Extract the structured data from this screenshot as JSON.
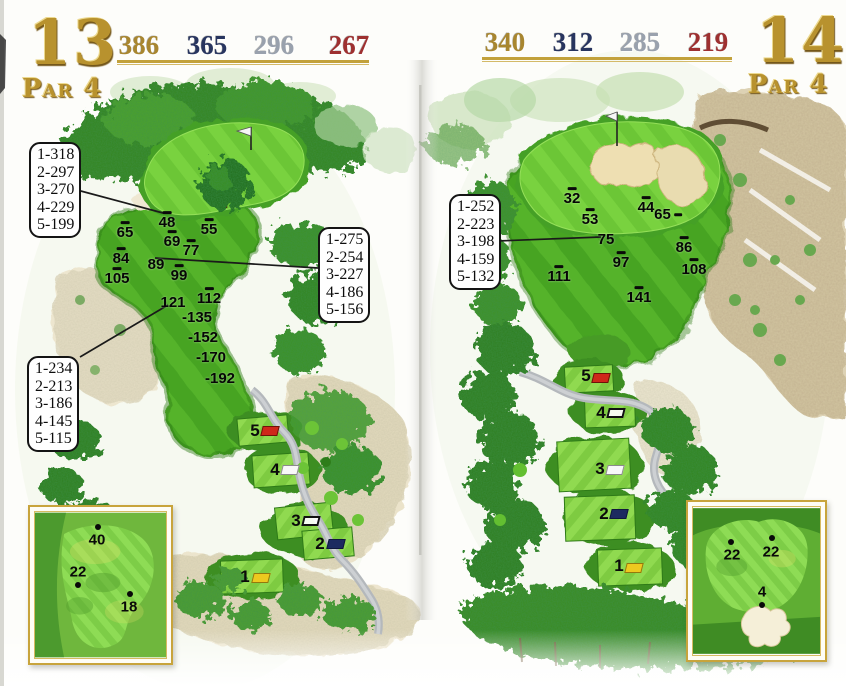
{
  "title": "Golf course yardage book spread — holes 13 and 14",
  "accent_gold": "#c2a13b",
  "tee_marker_colors": {
    "red": "#cf271a",
    "navy": "#1d2a60",
    "yellow": "#edc91f",
    "white": "#f8f8f8",
    "outline": "#ffffff"
  },
  "holes": [
    {
      "id": "13",
      "number": "13",
      "par": "Par 4",
      "distances": [
        {
          "value": "386",
          "color": "#a8862f",
          "x": 139,
          "y": 32
        },
        {
          "value": "365",
          "color": "#28355f",
          "x": 207,
          "y": 32
        },
        {
          "value": "296",
          "color": "#99a1ad",
          "x": 274,
          "y": 32
        },
        {
          "value": "267",
          "color": "#9e3030",
          "x": 349,
          "y": 32
        }
      ],
      "underline": {
        "x": 117,
        "y": 60,
        "w": 252
      },
      "callout_boxes": [
        {
          "x": 29,
          "y": 142,
          "lines": [
            "1-318",
            "2-297",
            "3-270",
            "4-229",
            "5-199"
          ]
        },
        {
          "x": 318,
          "y": 227,
          "lines": [
            "1-275",
            "2-254",
            "3-227",
            "4-186",
            "5-156"
          ]
        },
        {
          "x": 27,
          "y": 356,
          "lines": [
            "1-234",
            "2-213",
            "3-186",
            "4-145",
            "5-115"
          ]
        }
      ],
      "leader_lines": [
        {
          "x1": 77,
          "y1": 190,
          "x2": 163,
          "y2": 213
        },
        {
          "x1": 155,
          "y1": 258,
          "x2": 318,
          "y2": 268
        },
        {
          "x1": 80,
          "y1": 357,
          "x2": 168,
          "y2": 305
        }
      ],
      "yardage_markers": [
        {
          "label": "48",
          "x": 167,
          "y": 221,
          "dash": "above"
        },
        {
          "label": "65",
          "x": 125,
          "y": 231,
          "dash": "above"
        },
        {
          "label": "55",
          "x": 209,
          "y": 228,
          "dash": "above"
        },
        {
          "label": "69",
          "x": 172,
          "y": 240,
          "dash": "above"
        },
        {
          "label": "77",
          "x": 191,
          "y": 249,
          "dash": "above"
        },
        {
          "label": "84",
          "x": 121,
          "y": 257,
          "dash": "above"
        },
        {
          "label": "89",
          "x": 156,
          "y": 265,
          "dash": "none"
        },
        {
          "label": "99",
          "x": 179,
          "y": 274,
          "dash": "above"
        },
        {
          "label": "105",
          "x": 117,
          "y": 277,
          "dash": "above"
        },
        {
          "label": "121",
          "x": 173,
          "y": 303,
          "dash": "none"
        },
        {
          "label": "112",
          "x": 209,
          "y": 297,
          "dash": "above"
        },
        {
          "label": "-135",
          "x": 197,
          "y": 318,
          "dash": "none"
        },
        {
          "label": "-152",
          "x": 203,
          "y": 338,
          "dash": "none"
        },
        {
          "label": "-170",
          "x": 211,
          "y": 358,
          "dash": "none"
        },
        {
          "label": "-192",
          "x": 220,
          "y": 379,
          "dash": "none"
        }
      ],
      "tees": [
        {
          "label": "5",
          "style": "red",
          "label_x": 255,
          "label_y": 431,
          "marker_x": 270,
          "marker_y": 431
        },
        {
          "label": "4",
          "style": "white",
          "label_x": 275,
          "label_y": 470,
          "marker_x": 290,
          "marker_y": 470
        },
        {
          "label": "3",
          "style": "outline",
          "label_x": 296,
          "label_y": 521,
          "marker_x": 311,
          "marker_y": 521
        },
        {
          "label": "2",
          "style": "navy",
          "label_x": 320,
          "label_y": 544,
          "marker_x": 336,
          "marker_y": 544
        },
        {
          "label": "1",
          "style": "yellow",
          "label_x": 245,
          "label_y": 577,
          "marker_x": 261,
          "marker_y": 578
        }
      ],
      "green_inset_pins": [
        {
          "label": "40",
          "dot_x": 98,
          "dot_y": 527,
          "text_x": 97,
          "text_y": 540
        },
        {
          "label": "22",
          "dot_x": 78,
          "dot_y": 585,
          "text_x": 78,
          "text_y": 572
        },
        {
          "label": "18",
          "dot_x": 130,
          "dot_y": 594,
          "text_x": 129,
          "text_y": 607
        }
      ]
    },
    {
      "id": "14",
      "number": "14",
      "par": "Par 4",
      "distances": [
        {
          "value": "340",
          "color": "#a8862f",
          "x": 505,
          "y": 29
        },
        {
          "value": "312",
          "color": "#28355f",
          "x": 573,
          "y": 29
        },
        {
          "value": "285",
          "color": "#99a1ad",
          "x": 640,
          "y": 29
        },
        {
          "value": "219",
          "color": "#9e3030",
          "x": 708,
          "y": 29
        }
      ],
      "underline": {
        "x": 482,
        "y": 57,
        "w": 250
      },
      "callout_boxes": [
        {
          "x": 449,
          "y": 194,
          "lines": [
            "1-252",
            "2-223",
            "3-198",
            "4-159",
            "5-132"
          ]
        }
      ],
      "leader_lines": [
        {
          "x1": 497,
          "y1": 241,
          "x2": 601,
          "y2": 237
        }
      ],
      "yardage_markers": [
        {
          "label": "32",
          "x": 572,
          "y": 197,
          "dash": "above"
        },
        {
          "label": "53",
          "x": 590,
          "y": 218,
          "dash": "above"
        },
        {
          "label": "44",
          "x": 646,
          "y": 206,
          "dash": "above"
        },
        {
          "label": "65",
          "x": 668,
          "y": 215,
          "dash": "right"
        },
        {
          "label": "75",
          "x": 606,
          "y": 240,
          "dash": "none"
        },
        {
          "label": "86",
          "x": 684,
          "y": 246,
          "dash": "above"
        },
        {
          "label": "97",
          "x": 621,
          "y": 261,
          "dash": "above"
        },
        {
          "label": "108",
          "x": 694,
          "y": 268,
          "dash": "above"
        },
        {
          "label": "111",
          "x": 559,
          "y": 275,
          "dash": "above"
        },
        {
          "label": "141",
          "x": 639,
          "y": 296,
          "dash": "above"
        }
      ],
      "tees": [
        {
          "label": "5",
          "style": "red",
          "label_x": 586,
          "label_y": 376,
          "marker_x": 601,
          "marker_y": 378
        },
        {
          "label": "4",
          "style": "outline",
          "label_x": 601,
          "label_y": 413,
          "marker_x": 616,
          "marker_y": 413
        },
        {
          "label": "3",
          "style": "white",
          "label_x": 600,
          "label_y": 469,
          "marker_x": 615,
          "marker_y": 470
        },
        {
          "label": "2",
          "style": "navy",
          "label_x": 604,
          "label_y": 514,
          "marker_x": 619,
          "marker_y": 514
        },
        {
          "label": "1",
          "style": "yellow",
          "label_x": 619,
          "label_y": 566,
          "marker_x": 634,
          "marker_y": 568
        }
      ],
      "green_inset_pins": [
        {
          "label": "22",
          "dot_x": 731,
          "dot_y": 542,
          "text_x": 732,
          "text_y": 555
        },
        {
          "label": "22",
          "dot_x": 772,
          "dot_y": 538,
          "text_x": 771,
          "text_y": 552
        },
        {
          "label": "4",
          "dot_x": 762,
          "dot_y": 605,
          "text_x": 762,
          "text_y": 592
        }
      ]
    }
  ]
}
